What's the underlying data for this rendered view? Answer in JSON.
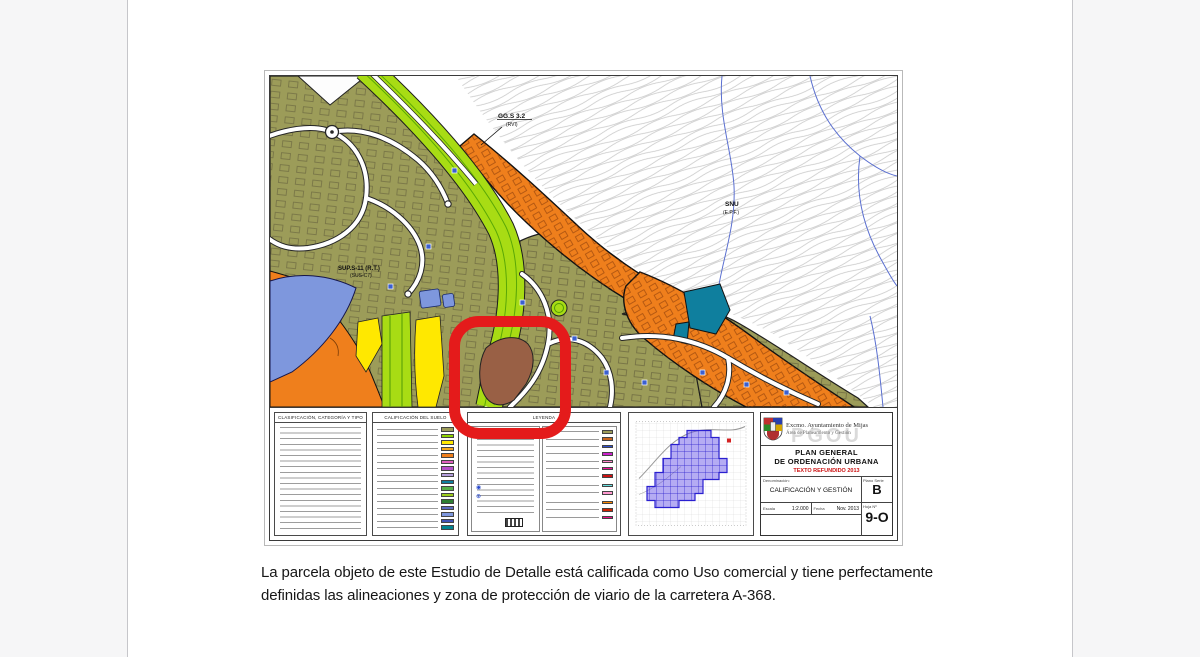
{
  "figure": {
    "map_labels": {
      "gg1": "GG.S 3.2",
      "gg2": "(RVI)",
      "snu1": "SNU",
      "snu2": "(E.P.F.)",
      "sup1": "SUP.S-11 (R.T.)",
      "sup2": "(SUS-C7)"
    },
    "legend": {
      "clasificacion_title": "CLASIFICACIÓN, CATEGORÍA Y TIPO",
      "calificacion_title": "CALIFICACIÓN DEL SUELO",
      "leyenda_title": "LEYENDA",
      "calificacion_swatches": [
        "#9c9c59",
        "#8fd400",
        "#ffe800",
        "#f6a81c",
        "#ef7f1c",
        "#e060c0",
        "#b44fc8",
        "#b39ddb",
        "#0f7f9e",
        "#55b047",
        "#9ccc1c",
        "#2e7d32",
        "#5c6bc0",
        "#7e97dd",
        "#3f51b5",
        "#00838f"
      ],
      "leyenda_swatches": [
        "#9c9c59",
        "#c8641e",
        "#2f4fd0",
        "#cc22cc",
        "#ff88cc",
        "#ee1199",
        "#cc1111",
        "#66e0e0",
        "#ff9ad0",
        "#ff8800",
        "#cc2200",
        "#ee1188"
      ]
    },
    "title_block": {
      "org_line1": "Excmo. Ayuntamiento de Mijas",
      "org_line2": "Área de Planeamiento y Gestión",
      "watermark": "PGOU",
      "plan_line1": "PLAN GENERAL",
      "plan_line2": "DE ORDENACIÓN URBANA",
      "refundido": "TEXTO REFUNDIDO 2013",
      "denominacion_label": "Denominación:",
      "denominacion_value": "CALIFICACIÓN Y GESTIÓN",
      "serie_label": "Plano Serie",
      "serie_value": "B",
      "escala_label": "Escala",
      "escala_value": "1:2.000",
      "fecha_label": "Fecha",
      "fecha_value": "Nov. 2013",
      "hoja_label": "Hoja Nº",
      "hoja_value": "9-O"
    },
    "zone_colors": {
      "olive": "#9c9c59",
      "lime": "#a8dc14",
      "orange": "#ef7f1c",
      "blue": "#7e97dd",
      "yellow": "#ffe800",
      "teal": "#0f7f9e",
      "brown": "#996045",
      "highlight_red": "#e41b1b"
    }
  },
  "caption": "La parcela objeto de este Estudio de Detalle está calificada como Uso comercial y tiene perfectamente definidas las alineaciones y zona de protección de viario de la carretera A-368."
}
